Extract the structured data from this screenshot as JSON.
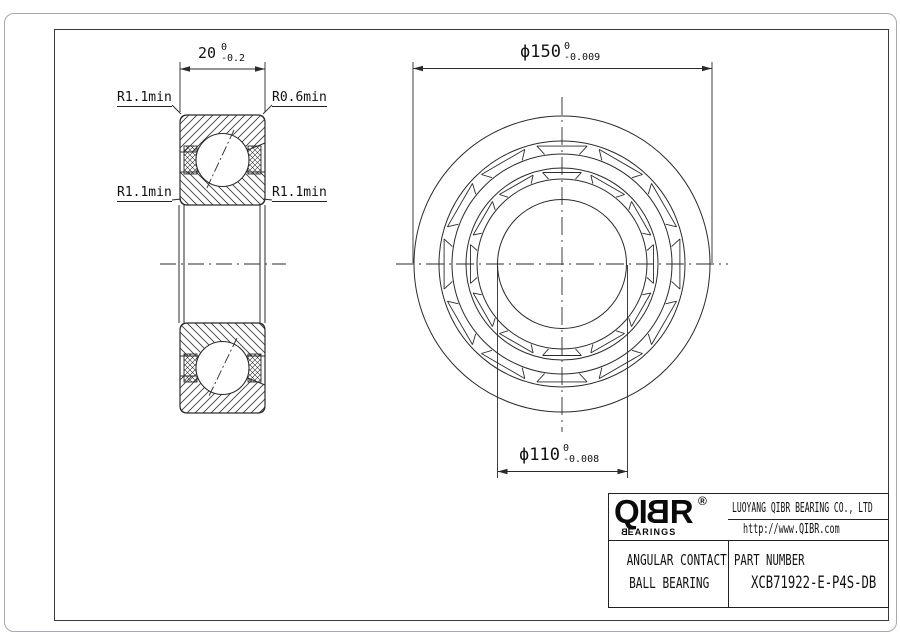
{
  "section_view": {
    "width_dim": {
      "value": "20",
      "tol_upper": "0",
      "tol_lower": "-0.2"
    },
    "labels": {
      "top_left": "R1.1min",
      "top_right": "R0.6min",
      "mid_left": "R1.1min",
      "mid_right": "R1.1min"
    }
  },
  "front_view": {
    "od_dim": {
      "text": "ϕ150",
      "tol_upper": "0",
      "tol_lower": "-0.009"
    },
    "bore_dim": {
      "text": "ϕ110",
      "tol_upper": "0",
      "tol_lower": "-0.008"
    }
  },
  "title_block": {
    "logo": {
      "letters": [
        "Q",
        "I",
        "B",
        "R"
      ],
      "registered": "®",
      "sub_first": "B",
      "sub_rest": "EARINGS"
    },
    "company": "LUOYANG QIBR BEARING CO., LTD",
    "url": "http://www.QIBR.com",
    "product_line1": "ANGULAR CONTACT",
    "product_line2": "BALL BEARING",
    "part_label": "PART NUMBER",
    "part_number": "XCB71922-E-P4S-DB"
  },
  "geometry": {
    "front": {
      "cx": 562,
      "cy": 264,
      "radii": [
        148,
        123,
        110,
        96,
        85,
        64.5
      ],
      "bands": [
        {
          "rOut": 123,
          "rIn": 110
        },
        {
          "rOut": 96,
          "rIn": 85
        }
      ],
      "pocket_count": 12,
      "pocket_half_deg": 12,
      "side_half_deg": 9
    },
    "colors": {
      "line": "#2b2b2b",
      "hatch": "#333333"
    }
  }
}
